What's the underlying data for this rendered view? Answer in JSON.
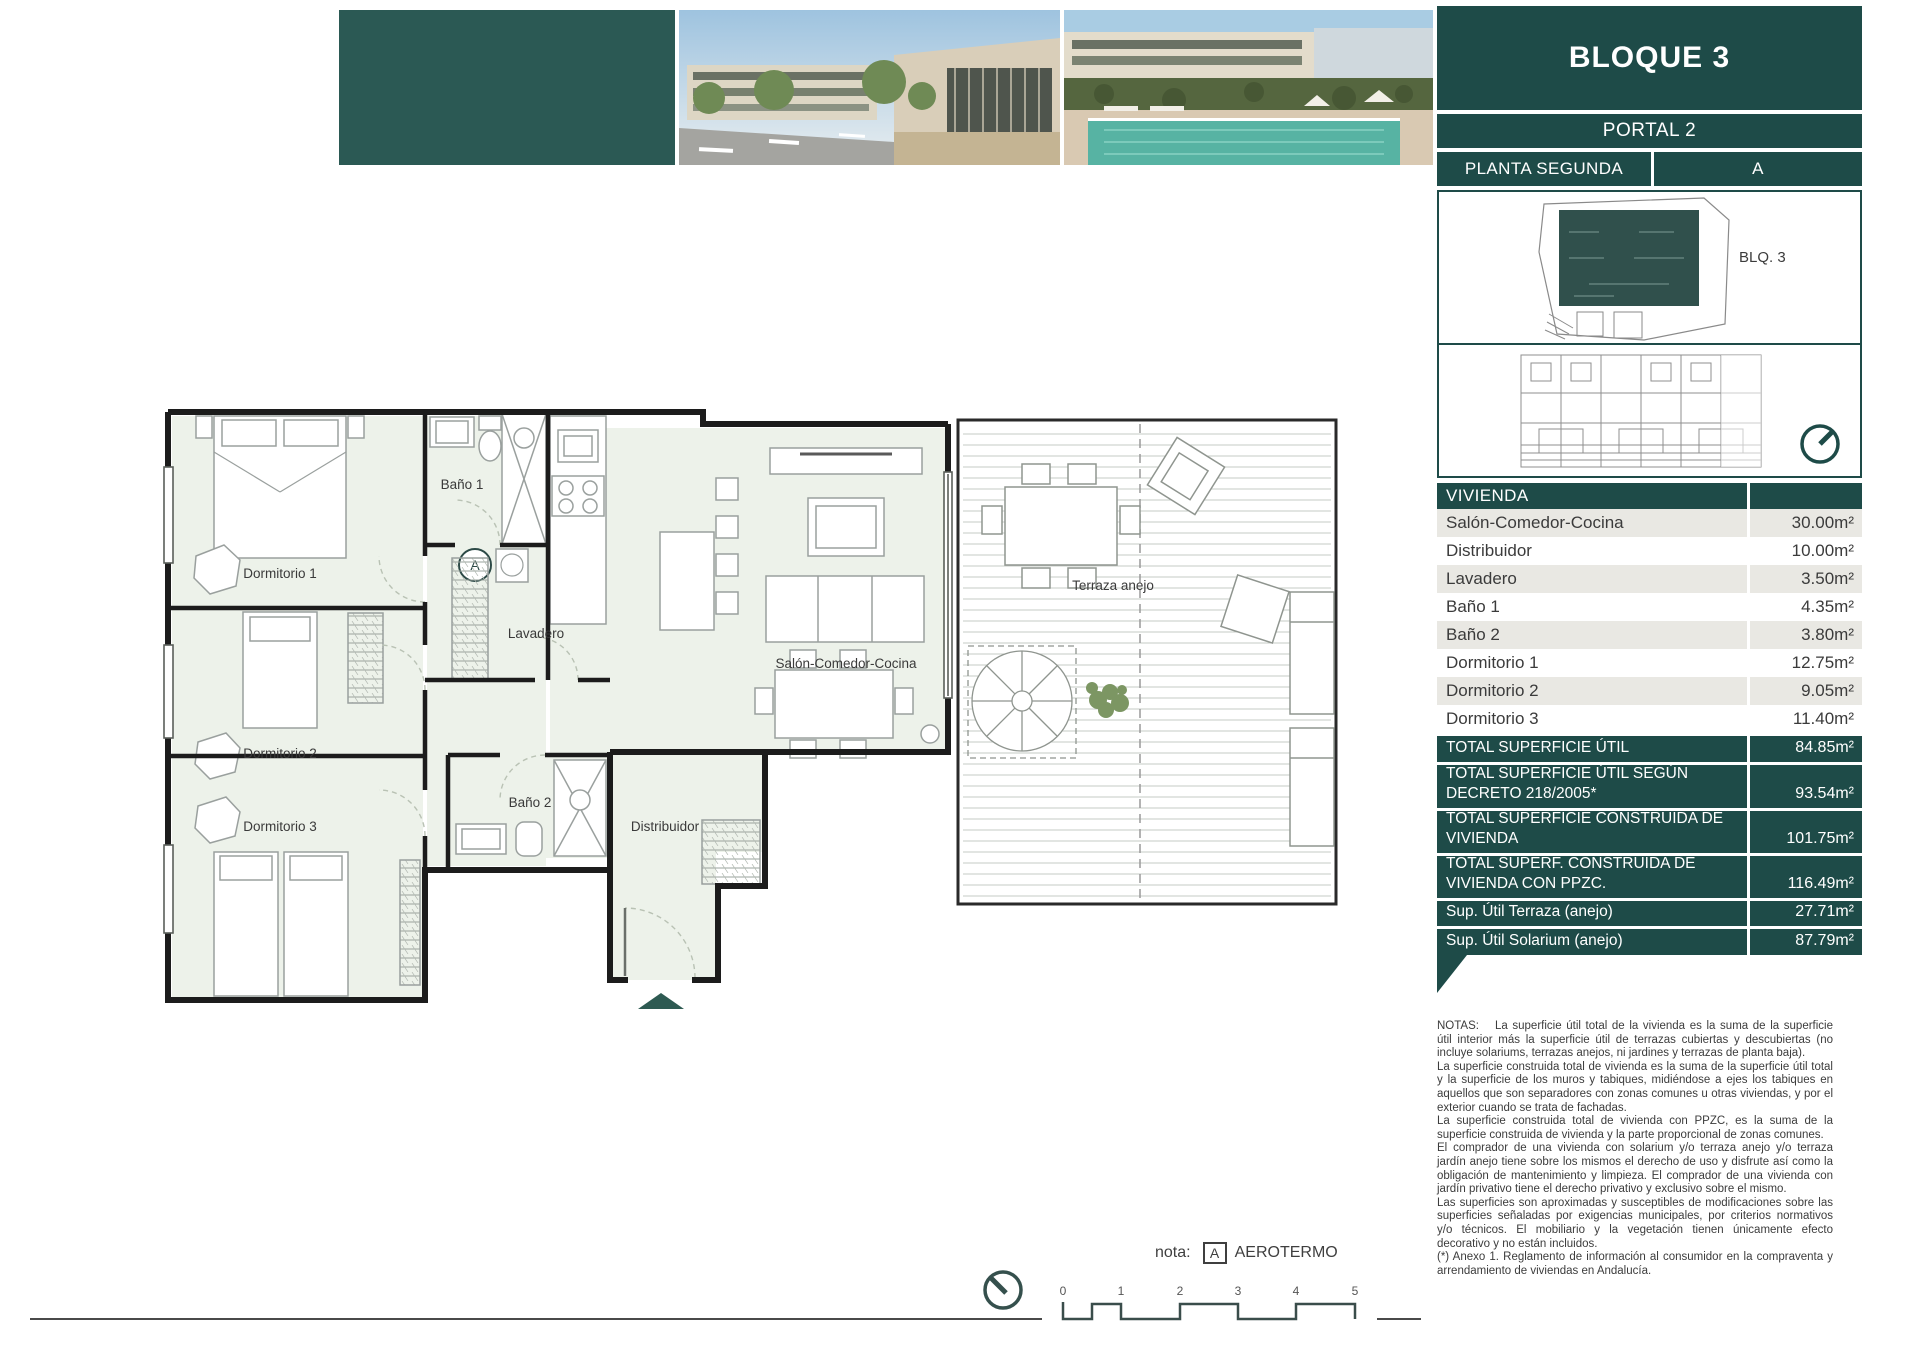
{
  "header": {
    "block_title": "BLOQUE 3",
    "portal": "PORTAL 2",
    "floor": "PLANTA SEGUNDA",
    "unit": "A",
    "site_plan_label": "BLQ. 3"
  },
  "table": {
    "header": "VIVIENDA",
    "rows": [
      {
        "label": "Salón-Comedor-Cocina",
        "value": "30.00m²"
      },
      {
        "label": "Distribuidor",
        "value": "10.00m²"
      },
      {
        "label": "Lavadero",
        "value": "3.50m²"
      },
      {
        "label": "Baño 1",
        "value": "4.35m²"
      },
      {
        "label": "Baño 2",
        "value": "3.80m²"
      },
      {
        "label": "Dormitorio 1",
        "value": "12.75m²"
      },
      {
        "label": "Dormitorio 2",
        "value": "9.05m²"
      },
      {
        "label": "Dormitorio 3",
        "value": "11.40m²"
      }
    ],
    "totals": [
      {
        "label": "TOTAL SUPERFICIE ÚTIL",
        "value": "84.85m²"
      },
      {
        "label": "TOTAL SUPERFICIE ÚTIL SEGÚN DECRETO 218/2005*",
        "value": "93.54m²"
      },
      {
        "label": "TOTAL SUPERFICIE CONSTRUIDA DE VIVIENDA",
        "value": "101.75m²"
      },
      {
        "label": "TOTAL SUPERF. CONSTRUIDA DE VIVIENDA CON PPZC.",
        "value": "116.49m²"
      },
      {
        "label": "Sup. Útil Terraza (anejo)",
        "value": "27.71m²"
      },
      {
        "label": "Sup. Útil Solarium (anejo)",
        "value": "87.79m²"
      }
    ]
  },
  "plan": {
    "rooms": {
      "dormitorio1": "Dormitorio 1",
      "dormitorio2": "Dormitorio 2",
      "dormitorio3": "Dormitorio 3",
      "bano1": "Baño 1",
      "bano2": "Baño 2",
      "lavadero": "Lavadero",
      "salon": "Salón-Comedor-Cocina",
      "distribuidor": "Distribuidor",
      "terraza": "Terraza anejo"
    },
    "aerotermo_marker": "A"
  },
  "footer": {
    "nota_label": "nota:",
    "nota_marker": "A",
    "nota_text": "AEROTERMO",
    "scale_ticks": [
      "0",
      "1",
      "2",
      "3",
      "4",
      "5"
    ]
  },
  "notes": {
    "title": "NOTAS:",
    "p1": "La superficie útil total de la vivienda es la suma de la superficie útil interior más la superficie útil de terrazas cubiertas y descubiertas (no incluye solariums, terrazas anejos, ni jardines y terrazas de planta baja).",
    "p2": "La superficie construida total de vivienda es la suma de la superficie útil total y la superficie de los muros y tabiques, midiéndose a ejes los tabiques en aquellos que son separadores con zonas comunes u otras viviendas, y por el exterior cuando se trata de fachadas.",
    "p3": "La superficie construida total de vivienda con PPZC, es la suma de la superficie construida de vivienda y la parte proporcional de zonas comunes.",
    "p4": "El comprador de una vivienda con solarium y/o terraza anejo y/o terraza jardín anejo tiene sobre los mismos el derecho de uso y disfrute así como la obligación de mantenimiento y limpieza. El comprador de una vivienda con jardín privativo tiene el derecho privativo y exclusivo sobre el mismo.",
    "p5": "Las superficies son aproximadas y susceptibles de modificaciones sobre las superficies señaladas por exigencias municipales, por criterios normativos y/o técnicos. El mobiliario y la vegetación tienen únicamente efecto decorativo y no están incluidos.",
    "p6": "(*) Anexo 1. Reglamento de información al consumidor en la compraventa y arrendamiento de viviendas en Andalucía."
  },
  "colors": {
    "teal": "#1e4b48",
    "photo_block_teal": "#2b5954",
    "row_gray": "#e9e8e3",
    "room_fill": "#edf2ea"
  }
}
